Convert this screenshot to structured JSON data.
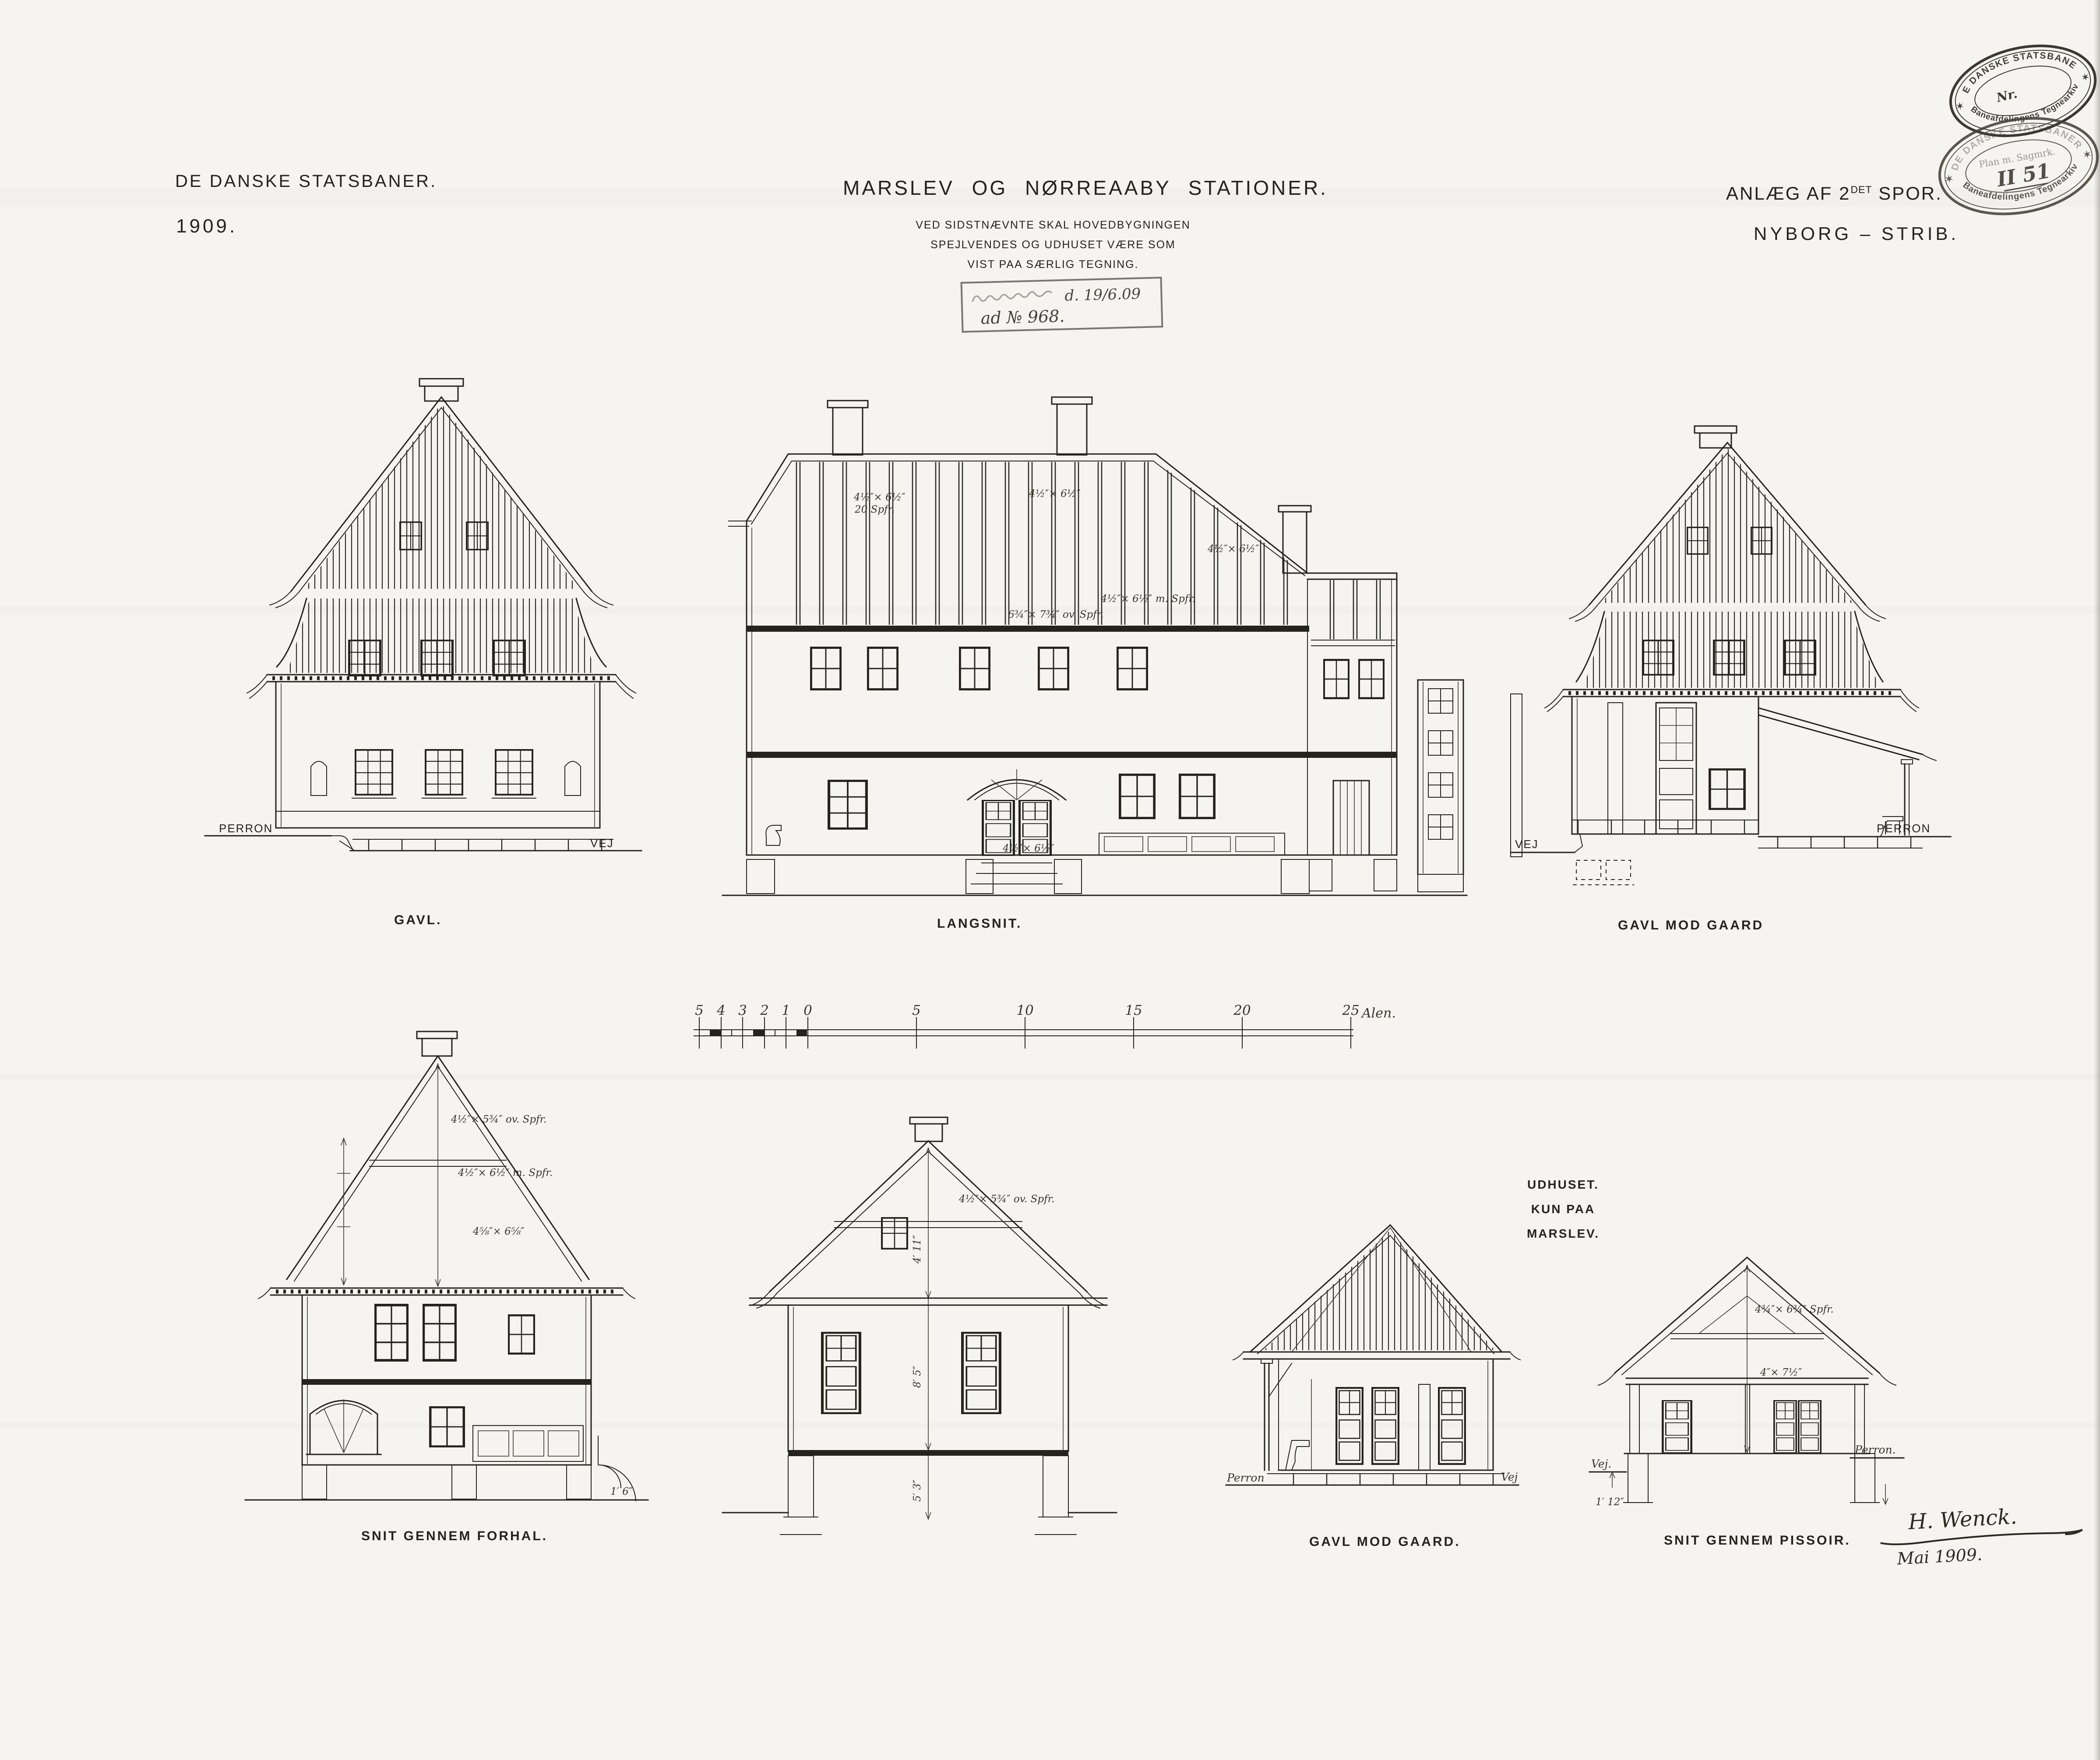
{
  "colors": {
    "paper": "#f5f4f1",
    "ink": "#26231e"
  },
  "header": {
    "org": "DE DANSKE STATSBANER.",
    "year": "1909.",
    "title": "MARSLEV OG NØRREAABY STATIONER.",
    "subtitle": [
      "VED SIDSTNÆVNTE SKAL HOVEDBYGNINGEN",
      "SPEJLVENDES OG UDHUSET VÆRE SOM",
      "VIST PAA SÆRLIG TEGNING."
    ],
    "project": {
      "prefix": "ANLÆG AF 2",
      "sup": "DET",
      "suffix": " SPOR."
    },
    "route": "NYBORG – STRIB."
  },
  "stamps": {
    "archive_upper": {
      "arc_top": "DE DANSKE STATSBANER",
      "center": "Nr.",
      "arc_bottom": "Baneafdelingens Tegnearkiv",
      "star": "✶"
    },
    "archive_lower": {
      "arc_top": "DE DANSKE STATSBANER",
      "center_line1": "Plan m. Sagmrk.",
      "center_line2": "II 51",
      "arc_bottom": "Baneafdelingens Tegnearkiv",
      "star": "✶"
    },
    "approval": {
      "date": "d. 19/6.09",
      "number": "ad № 968."
    }
  },
  "scale_bar": {
    "ticks": [
      "5",
      "4",
      "3",
      "2",
      "1",
      "0",
      "5",
      "10",
      "15",
      "20",
      "25"
    ],
    "unit": "Alen."
  },
  "drawings": {
    "gavl": {
      "caption": "GAVL.",
      "left_label": "PERRON",
      "right_label": "VEJ"
    },
    "langsnit": {
      "caption": "LANGSNIT.",
      "annotations": [
        "4½″× 6½″",
        "20 Spfr.",
        "4½″× 6½″",
        "4½″× 6½″",
        "6¾″× 7¾″ ov. Spfr.",
        "4½″× 6½″ m. Spfr.",
        "4½″× 6½″"
      ]
    },
    "gavl_mod_gaard": {
      "caption": "GAVL MOD GAARD",
      "left_label": "VEJ",
      "right_label": "PERRON"
    },
    "forhal": {
      "caption": "SNIT GENNEM FORHAL.",
      "annotations": [
        "4½″× 5¾″ ov. Spfr.",
        "4½″× 6½″ m. Spfr.",
        "4⅝″× 6⅝″",
        "1′ 6″"
      ]
    },
    "tvaersnit": {
      "annotations": [
        "4½″× 5¾″ ov. Spfr.",
        "4′ 11″",
        "8′ 5″",
        "5′ 3″"
      ]
    },
    "udhus": {
      "heading_line1": "UDHUSET.",
      "heading_line2": "KUN PAA MARSLEV.",
      "caption": "GAVL MOD GAARD.",
      "left_label": "Perron",
      "right_label": "Vej"
    },
    "pissoir": {
      "caption": "SNIT GENNEM PISSOIR.",
      "left_label": "Vej.",
      "right_label": "Perron.",
      "dim_label": "1′ 12″",
      "annotations": [
        "4¾″× 6¾″ Spfr.",
        "4″× 7½″"
      ]
    }
  },
  "signature": {
    "name": "H. Wenck.",
    "date": "Mai 1909."
  }
}
